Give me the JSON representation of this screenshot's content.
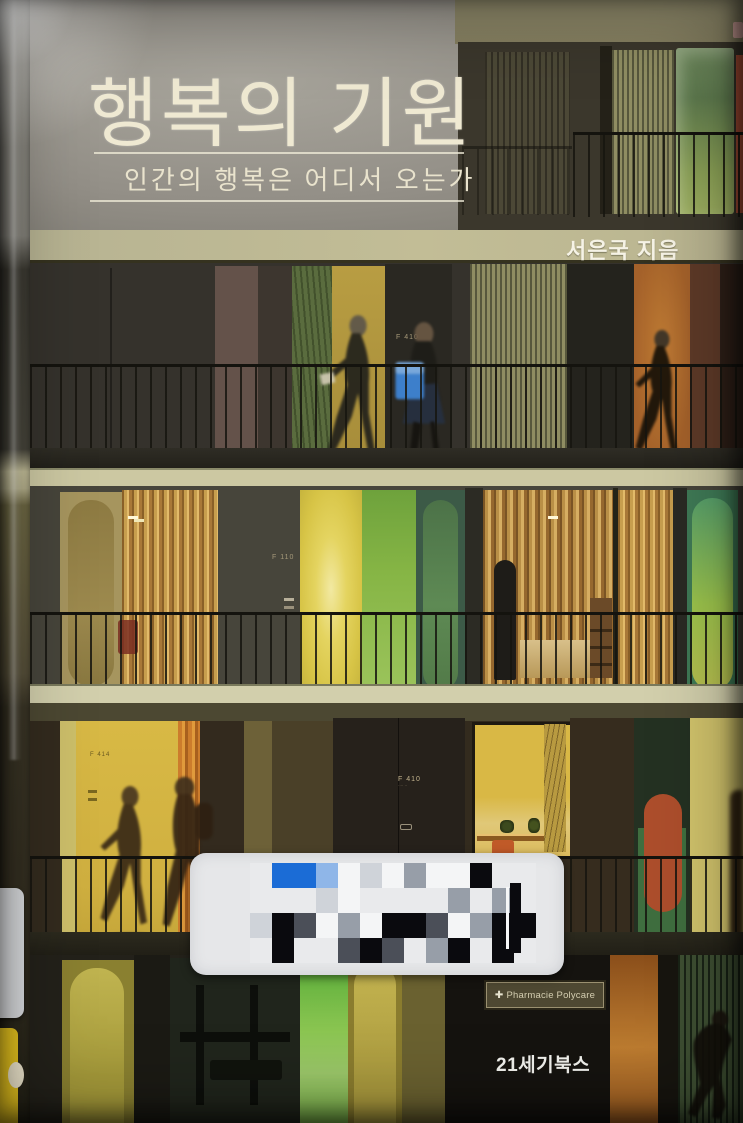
{
  "book": {
    "title": "행복의 기원",
    "subtitle": "인간의 행복은 어디서 오는가",
    "author": "서은국 지음",
    "publisher": "21세기북스"
  },
  "photo": {
    "pharmacy_cross": "✚",
    "pharmacy_sign": "Pharmacie Polycare",
    "door_labels": {
      "floor2": "F 410",
      "floor3": "F 110",
      "floor4_left": "F 414",
      "floor4_main": "F 410",
      "floor4_main_sub": "····  ··"
    }
  },
  "palette": {
    "title-text": "#efe9d2",
    "subtitle-text": "#e9e3cd",
    "slab-band": "#c2bd96",
    "author-text": "#f6f3e6",
    "publisher-text": "#f2f2ee",
    "sign-bg": "#4e4832",
    "sign-text": "#d4cdb0",
    "sticker-bg": "#e6e7e9",
    "pixel-blue": "#1b6cd6",
    "spine-sticker-yellow": "#e8c51f",
    "yellow-door": "#d8b945",
    "orange-panel": "#a4612a",
    "green-panel": "#86b545",
    "red-art": "#ad4e2c"
  },
  "barcode_sticker": {
    "grid": {
      "origin_x": 60,
      "origin_y": 10,
      "cell_w": 22,
      "cell_h": 25,
      "rows": [
        "eBBbwlwgwwKee",
        "eeelweeeegege",
        "lKdwgwKKdwgKK",
        "eKeedKdegKeKe"
      ],
      "colors": {
        "e": "#e9eaec",
        "w": "#f4f5f6",
        "l": "#cfd3d9",
        "g": "#979ea8",
        "d": "#4b4f58",
        "K": "#0a0a0e",
        "B": "#1b6cd6",
        "b": "#8fb6e8",
        "p": "#e6dee8"
      }
    }
  }
}
